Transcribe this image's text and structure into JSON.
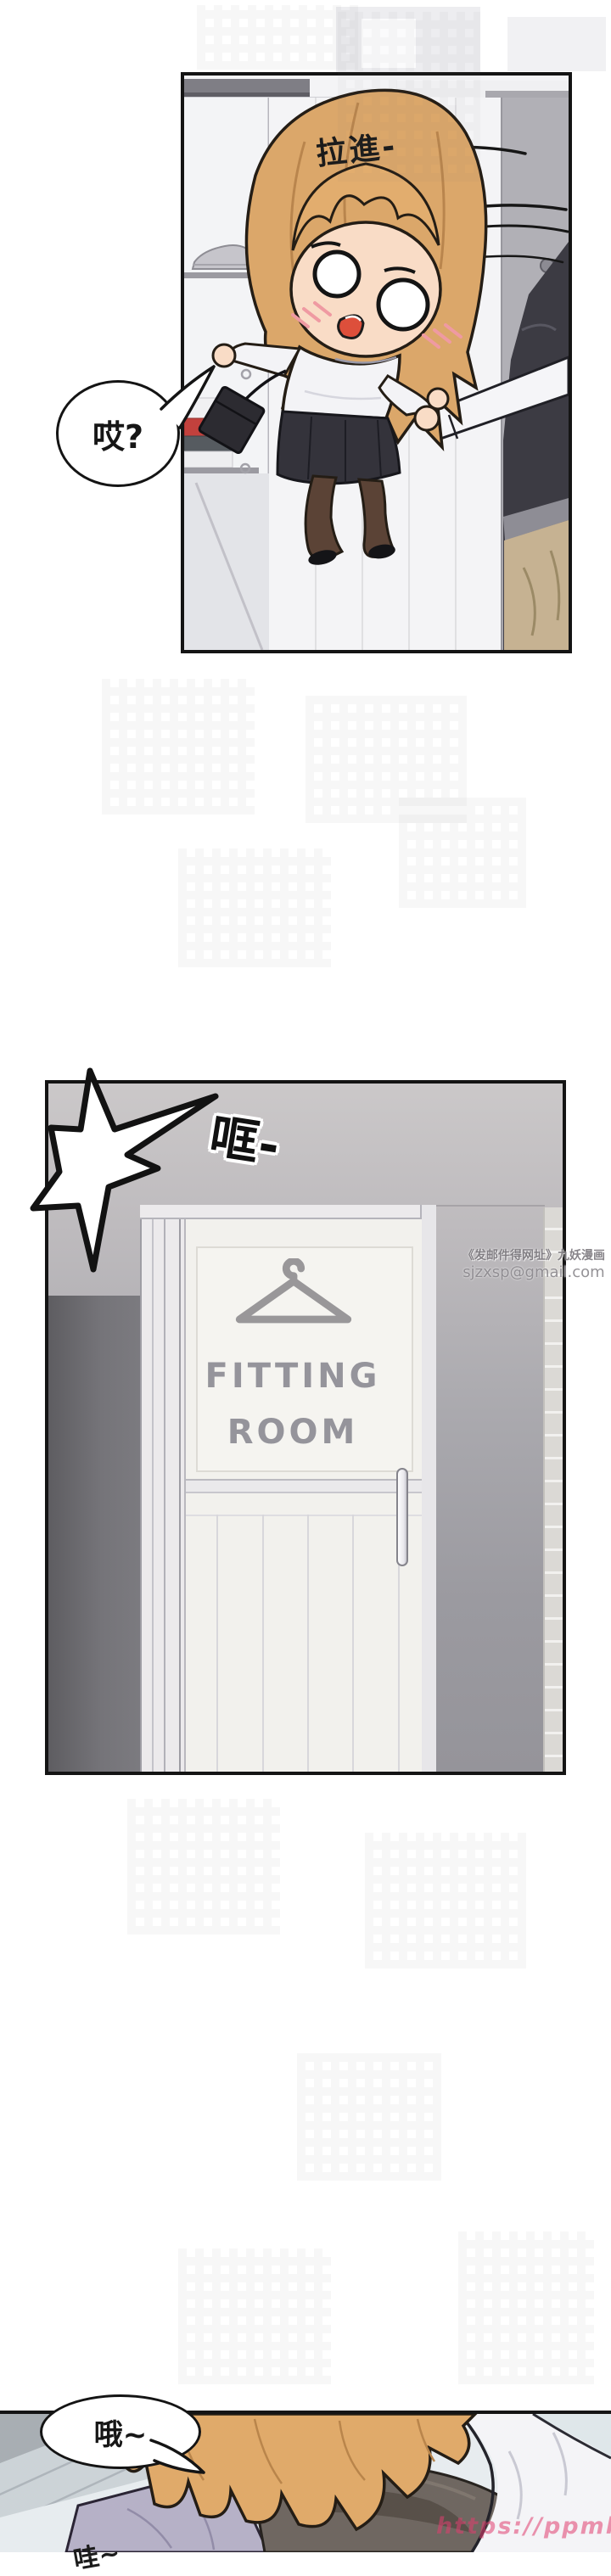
{
  "page": {
    "background": "#ffffff",
    "site_watermark": "https://ppmh.app"
  },
  "panel_pull": {
    "sfx": "拉進-",
    "speech": "哎?"
  },
  "panel_fitting_room": {
    "sfx": "哐-",
    "door_sign_line1": "FITTING",
    "door_sign_line2": "ROOM",
    "watermark_line1": "《发邮件得网址》九妖漫画",
    "watermark_line2": "sjzxsp@gmail.com"
  },
  "panel_closeup": {
    "speech": "哦~",
    "sfx_partial": "哇~"
  },
  "colors": {
    "panel_border": "#141414",
    "hair_blonde": "#dca76a",
    "skin": "#f9dcc6",
    "wall_gray": "#9b9aa0",
    "dark_wall": "#5e5d61",
    "door_white": "#f2f1ed",
    "sign_gray": "#95949b",
    "skirt_black": "#34333b",
    "red_cloth": "#c2413d",
    "lavender_top": "#b6b1c7",
    "url_pink": "#e03e70"
  }
}
